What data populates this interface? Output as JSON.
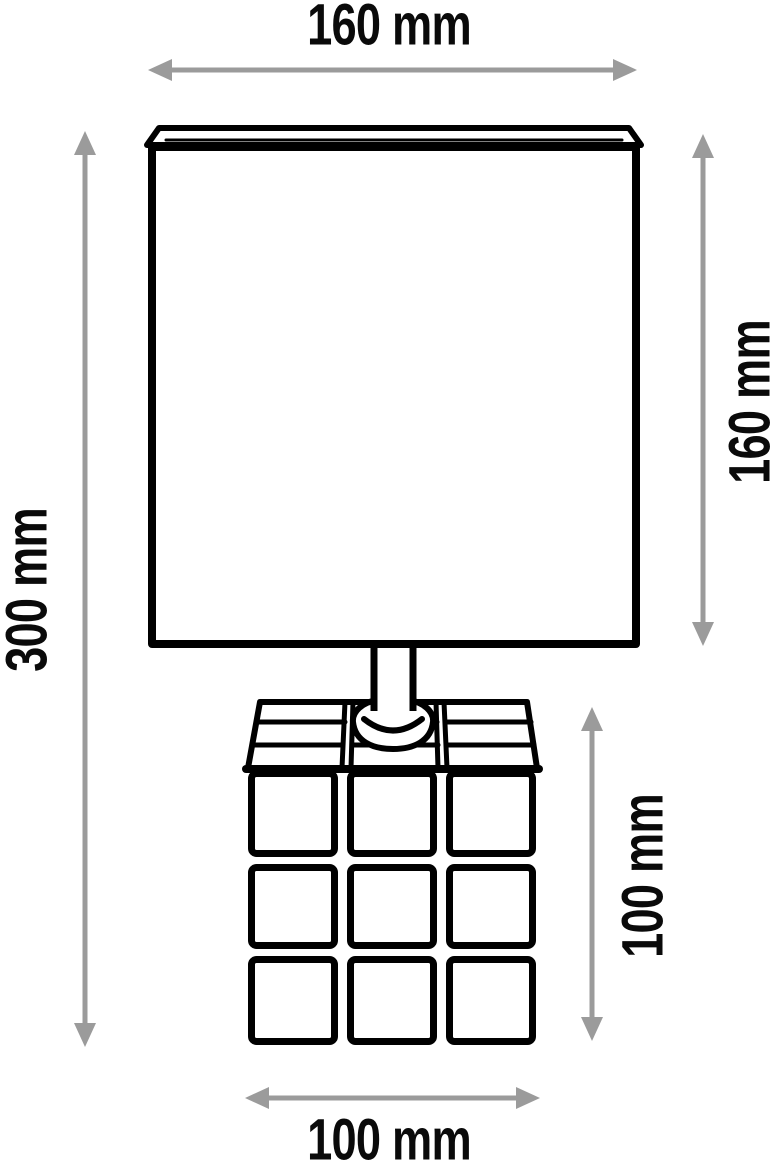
{
  "unit": "mm",
  "dimensions": {
    "shade_width": {
      "label": "160 mm",
      "value": 160,
      "location": "top"
    },
    "shade_height": {
      "label": "160 mm",
      "value": 160,
      "location": "right-upper"
    },
    "total_height": {
      "label": "300 mm",
      "value": 300,
      "location": "left"
    },
    "base_height": {
      "label": "100 mm",
      "value": 100,
      "location": "right-lower"
    },
    "base_width": {
      "label": "100 mm",
      "value": 100,
      "location": "bottom"
    }
  },
  "colors": {
    "line": "#000000",
    "dimension_arrow": "#9b9b9b",
    "text": "#0a0a0a",
    "background": "#ffffff"
  }
}
